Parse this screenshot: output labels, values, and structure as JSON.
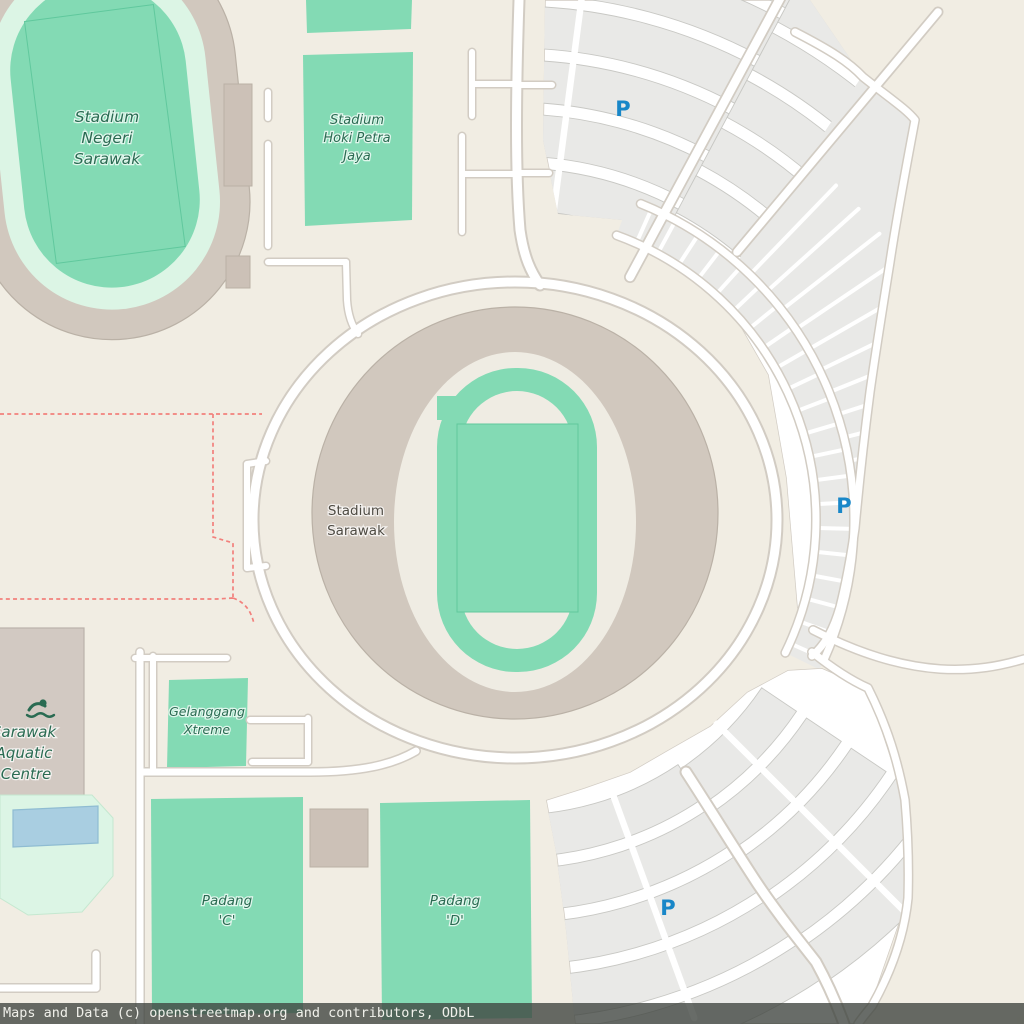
{
  "map": {
    "labels": {
      "stadium_negeri": {
        "lines": [
          "Stadium",
          "Negeri",
          "Sarawak"
        ]
      },
      "stadium_hoki": {
        "lines": [
          "Stadium",
          "Hoki Petra",
          "Jaya"
        ]
      },
      "stadium_sarawak": {
        "lines": [
          "Stadium",
          "Sarawak"
        ]
      },
      "aquatic_centre": {
        "lines": [
          "Sarawak",
          "Aquatic",
          "Centre"
        ]
      },
      "gelanggang": {
        "lines": [
          "Gelanggang",
          "Xtreme"
        ]
      },
      "padang_c": {
        "lines": [
          "Padang",
          "'C'"
        ]
      },
      "padang_d": {
        "lines": [
          "Padang",
          "'D'"
        ]
      },
      "parking_symbol": "P"
    },
    "colors": {
      "land": "#f1ede3",
      "parking_fill": "#e9e9e7",
      "parking_stroke": "#c8c8c4",
      "parking_aisle": "#ffffff",
      "road_fill": "#ffffff",
      "road_casing": "#d2ccc3",
      "pitch_green": "#83dab4",
      "pitch_stroke": "#60c89d",
      "stand_fill": "#d1c8be",
      "stand_stroke": "#bab1a6",
      "block_fill": "#ccc1b7",
      "building_fill": "#d2c9c2",
      "building_stroke": "#bbb2ab",
      "mint_light": "#dcf5e5",
      "mint_stroke": "#c5e8d0",
      "inner_beige": "#efece3",
      "pool_fill": "#a9cee1",
      "pool_stroke": "#8fbcd2",
      "label_green": "#2a6b52",
      "label_gray": "#4e4b43",
      "parking_blue": "#1987c8",
      "boundary_red": "#f2807c",
      "attribution_bg": "rgba(62,66,61,0.78)",
      "attribution_text": "#f0f0ea"
    },
    "attribution": "Maps and Data (c) openstreetmap.org and contributors, ODbL"
  }
}
